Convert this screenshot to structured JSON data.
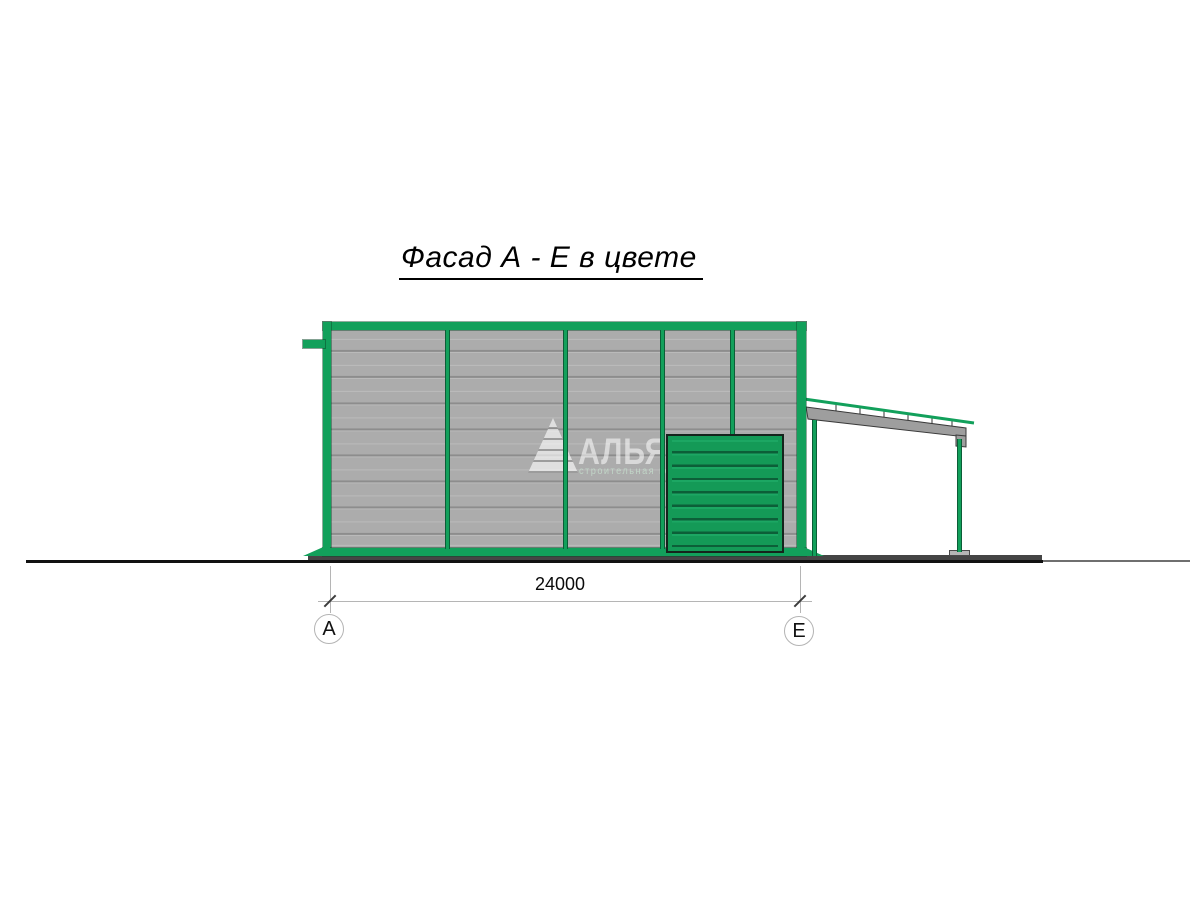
{
  "drawing": {
    "title": "Фасад А - Е в цвете",
    "dimension_label": "24000",
    "axis_a": "А",
    "axis_e": "Е",
    "watermark_name": "АЛЬЯНС",
    "watermark_tagline": "строительная компания",
    "colors": {
      "frame_green": "#12a05b",
      "door_green": "#149a57",
      "panel_gray": "#acacac",
      "panel_joint_gray": "#8d8d8d",
      "beam_gray": "#9e9e9e",
      "plinth_gray": "#454545",
      "ground_black": "#111111"
    }
  }
}
